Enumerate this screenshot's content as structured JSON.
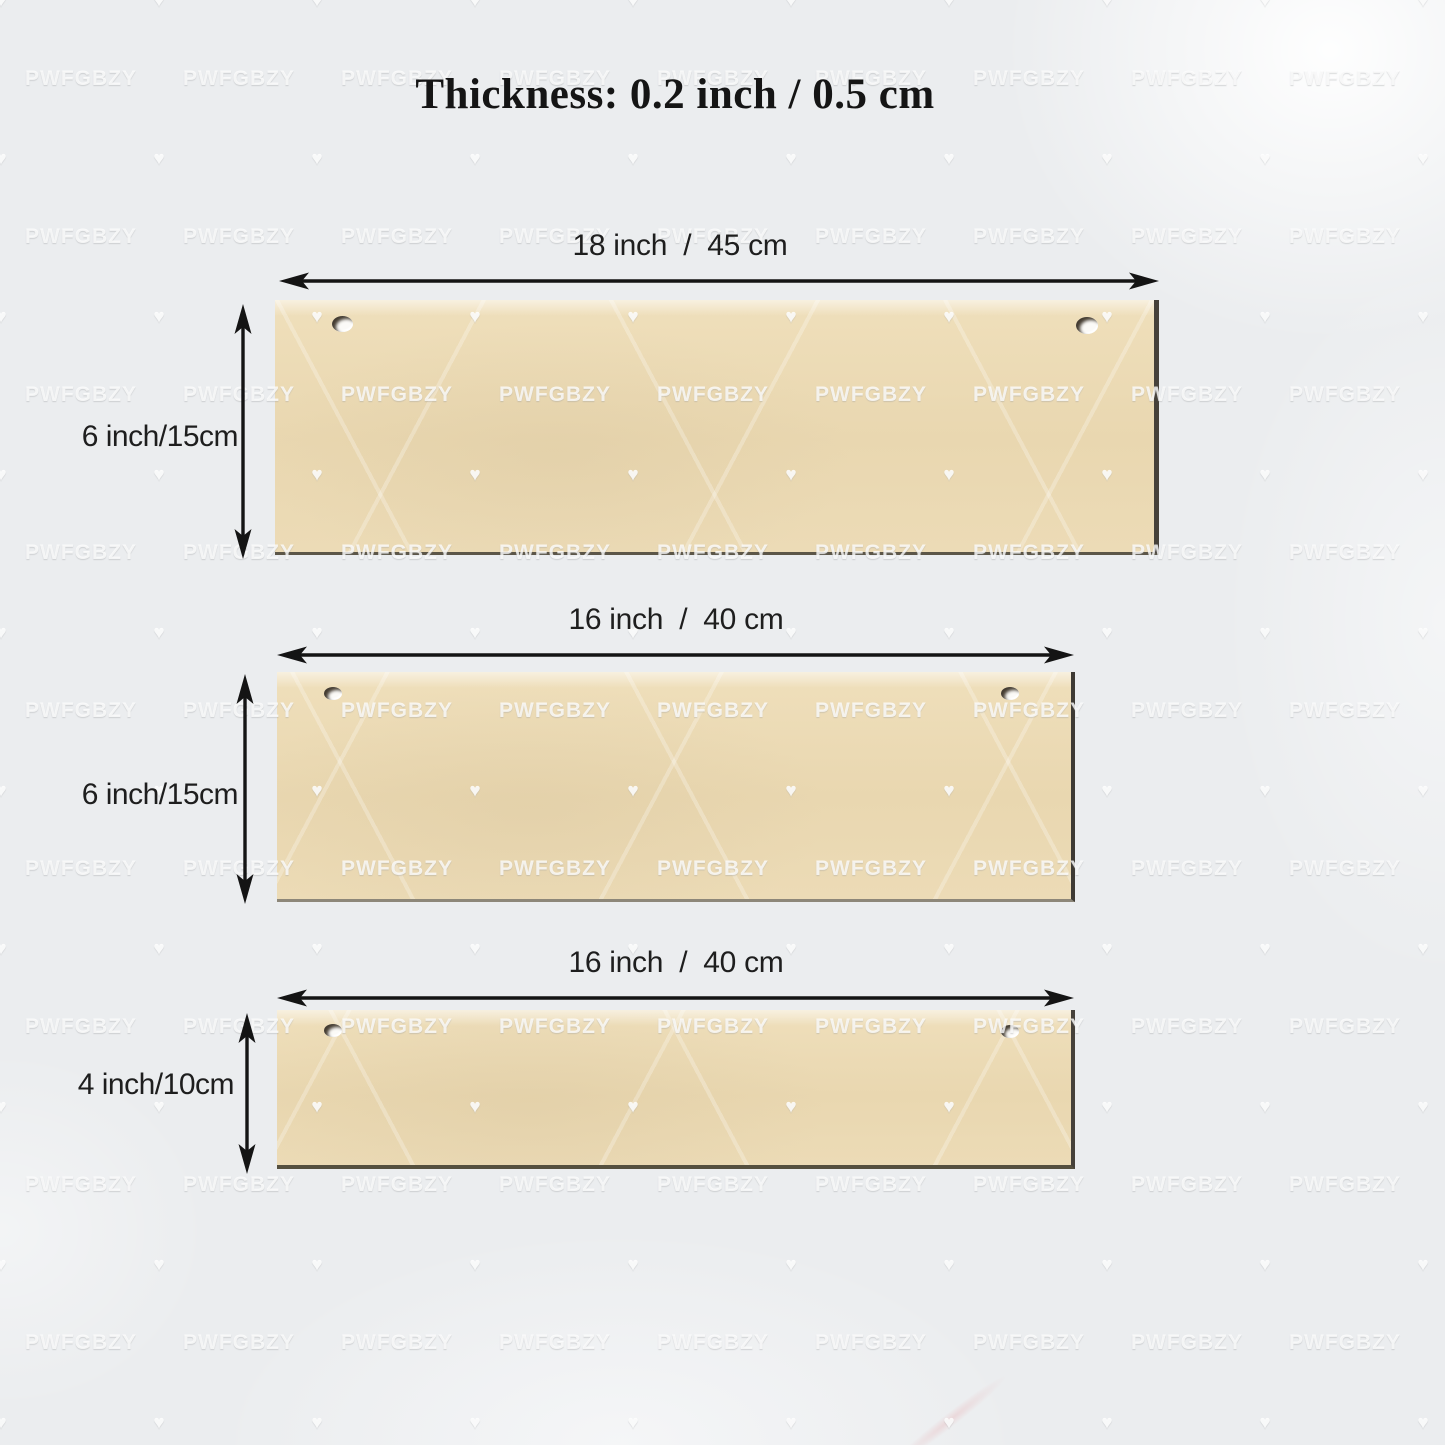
{
  "title": "Thickness: 0.2 inch / 0.5 cm",
  "watermark": {
    "text": "PWFGBZY",
    "icon_glyph": "♥"
  },
  "colors": {
    "background": "#ebedef",
    "wood": "#ead8b2",
    "wood_edge": "#46413a",
    "annotation": "#1e1e1e",
    "watermark": "#ffffff"
  },
  "boards": [
    {
      "width_label": "18 inch  /  45 cm",
      "height_label": "6 inch/15cm"
    },
    {
      "width_label": "16 inch  /  40 cm",
      "height_label": "6 inch/15cm"
    },
    {
      "width_label": "16 inch  /  40 cm",
      "height_label": "4 inch/10cm"
    }
  ]
}
